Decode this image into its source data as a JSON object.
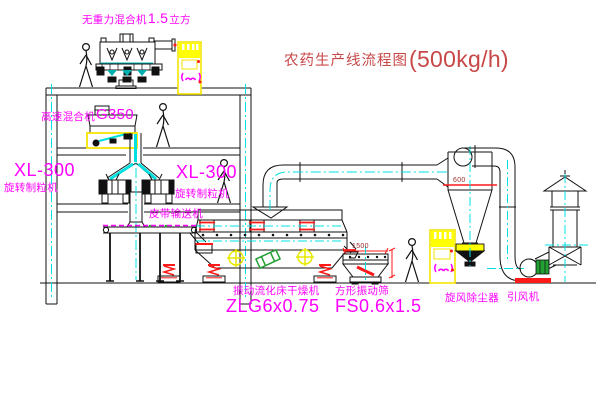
{
  "title": {
    "name": "农药生产线流程图",
    "capacity": "(500kg/h)"
  },
  "equipment_labels": {
    "gravity_mixer": {
      "name": "无重力混合机",
      "size": "1.5",
      "unit": "立方"
    },
    "high_speed_mixer": {
      "name": "高速混合机",
      "model": "G350"
    },
    "granulator_left": {
      "model": "XL-300",
      "name": "旋转制粒机"
    },
    "granulator_right": {
      "model": "XL-300",
      "name": "旋转制粒机"
    },
    "belt_conveyor": {
      "name": "皮带输送机"
    },
    "fluid_bed_dryer": {
      "name": "振动流化床干燥机",
      "model": "ZLG6x0.75"
    },
    "vibrating_screen": {
      "name": "方形振动筛",
      "model": "FS0.6x1.5",
      "dimension": "1500"
    },
    "cyclone": {
      "name": "旋风除尘器",
      "dimension": "600"
    },
    "draft_fan": {
      "name": "引风机"
    }
  },
  "colors": {
    "label_magenta": "#ff00ff",
    "title_red": "#c84848",
    "dimension_red": "#a03030",
    "centerline_cyan": "#00e0e0",
    "cabinet_yellow": "#ffff00",
    "flange_red": "#ff1a1a",
    "motor_green": "#22a033"
  }
}
